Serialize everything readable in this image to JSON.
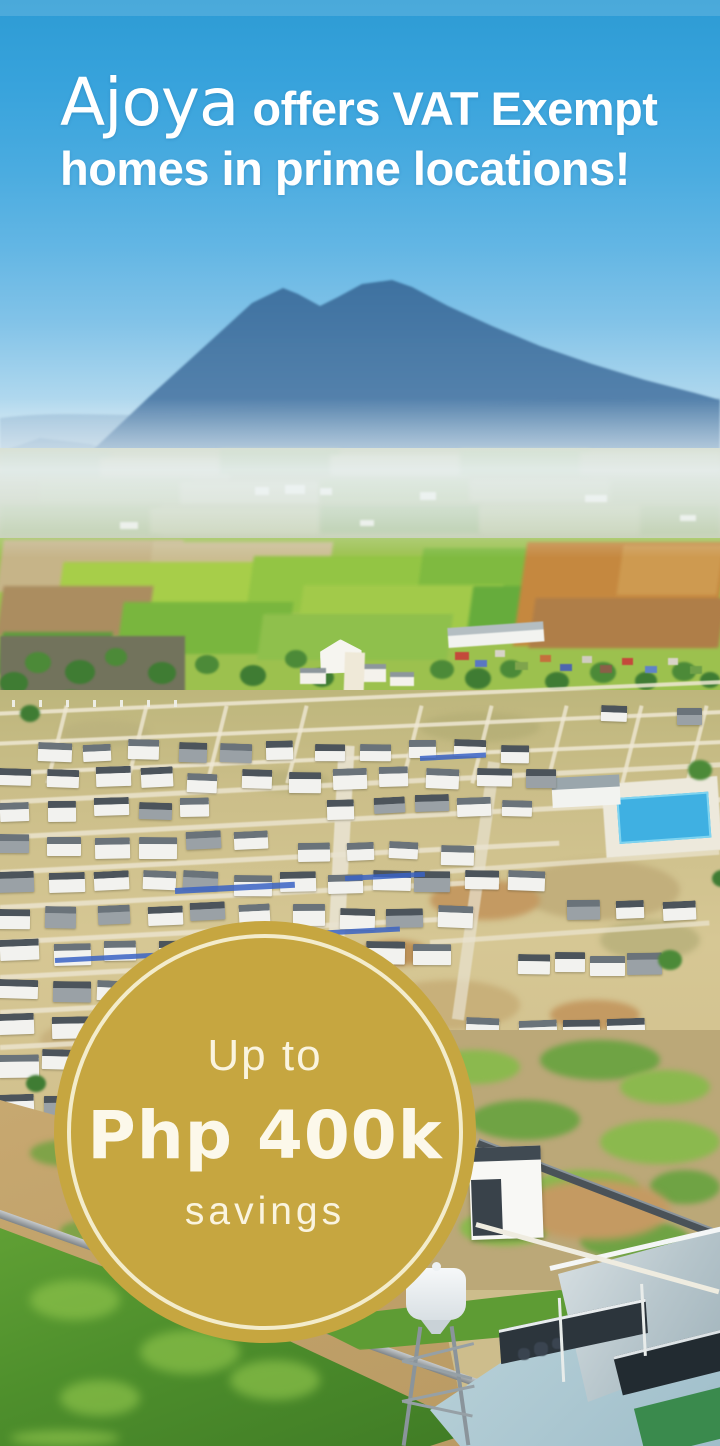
{
  "headline": {
    "brand": "Ajoya",
    "line1_rest": "offers VAT Exempt",
    "line2": "homes in prime locations!"
  },
  "badge": {
    "line1": "Up to",
    "line2": "Php 400k",
    "line3": "savings",
    "background_color": "#C6A640",
    "ring_color": "#F6EFD3",
    "text_color": "#FBF6E6"
  },
  "colors": {
    "sky_top": "#2D9BD4",
    "sky_horizon": "#E6EFF1",
    "mountain": "#4A78A4",
    "headline_text": "#FFFFFF"
  }
}
